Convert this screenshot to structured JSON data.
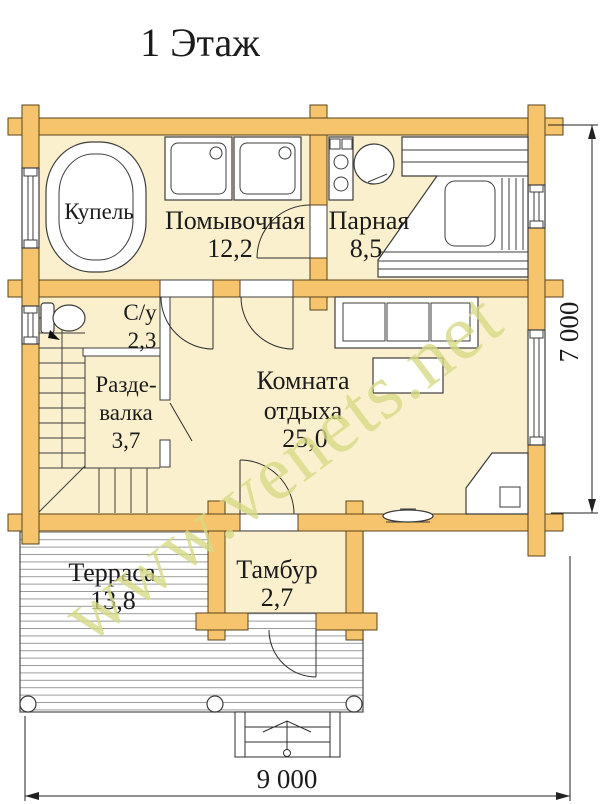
{
  "title": "1 Этаж",
  "rooms": {
    "kupel": {
      "name": "Купель"
    },
    "pomyvochnaya": {
      "name": "Помывочная",
      "area": "12,2"
    },
    "parnaya": {
      "name": "Парная",
      "area": "8,5"
    },
    "su": {
      "name": "С/у",
      "area": "2,3"
    },
    "razdevalka": {
      "name_line1": "Разде-",
      "name_line2": "валка",
      "area": "3,7"
    },
    "komnata": {
      "name_line1": "Комната",
      "name_line2": "отдыха",
      "area": "25,0"
    },
    "terrasa": {
      "name": "Терраса",
      "area": "13,8"
    },
    "tambur": {
      "name": "Тамбур",
      "area": "2,7"
    }
  },
  "dimensions": {
    "width": "9 000",
    "height": "7 000"
  },
  "watermark": "www.venets.net",
  "colors": {
    "wall": "#f7c46e",
    "wall_outline": "#5a431a",
    "floor": "#faf0ce",
    "watermark": "#d6da84",
    "line": "#3c3c3c"
  }
}
